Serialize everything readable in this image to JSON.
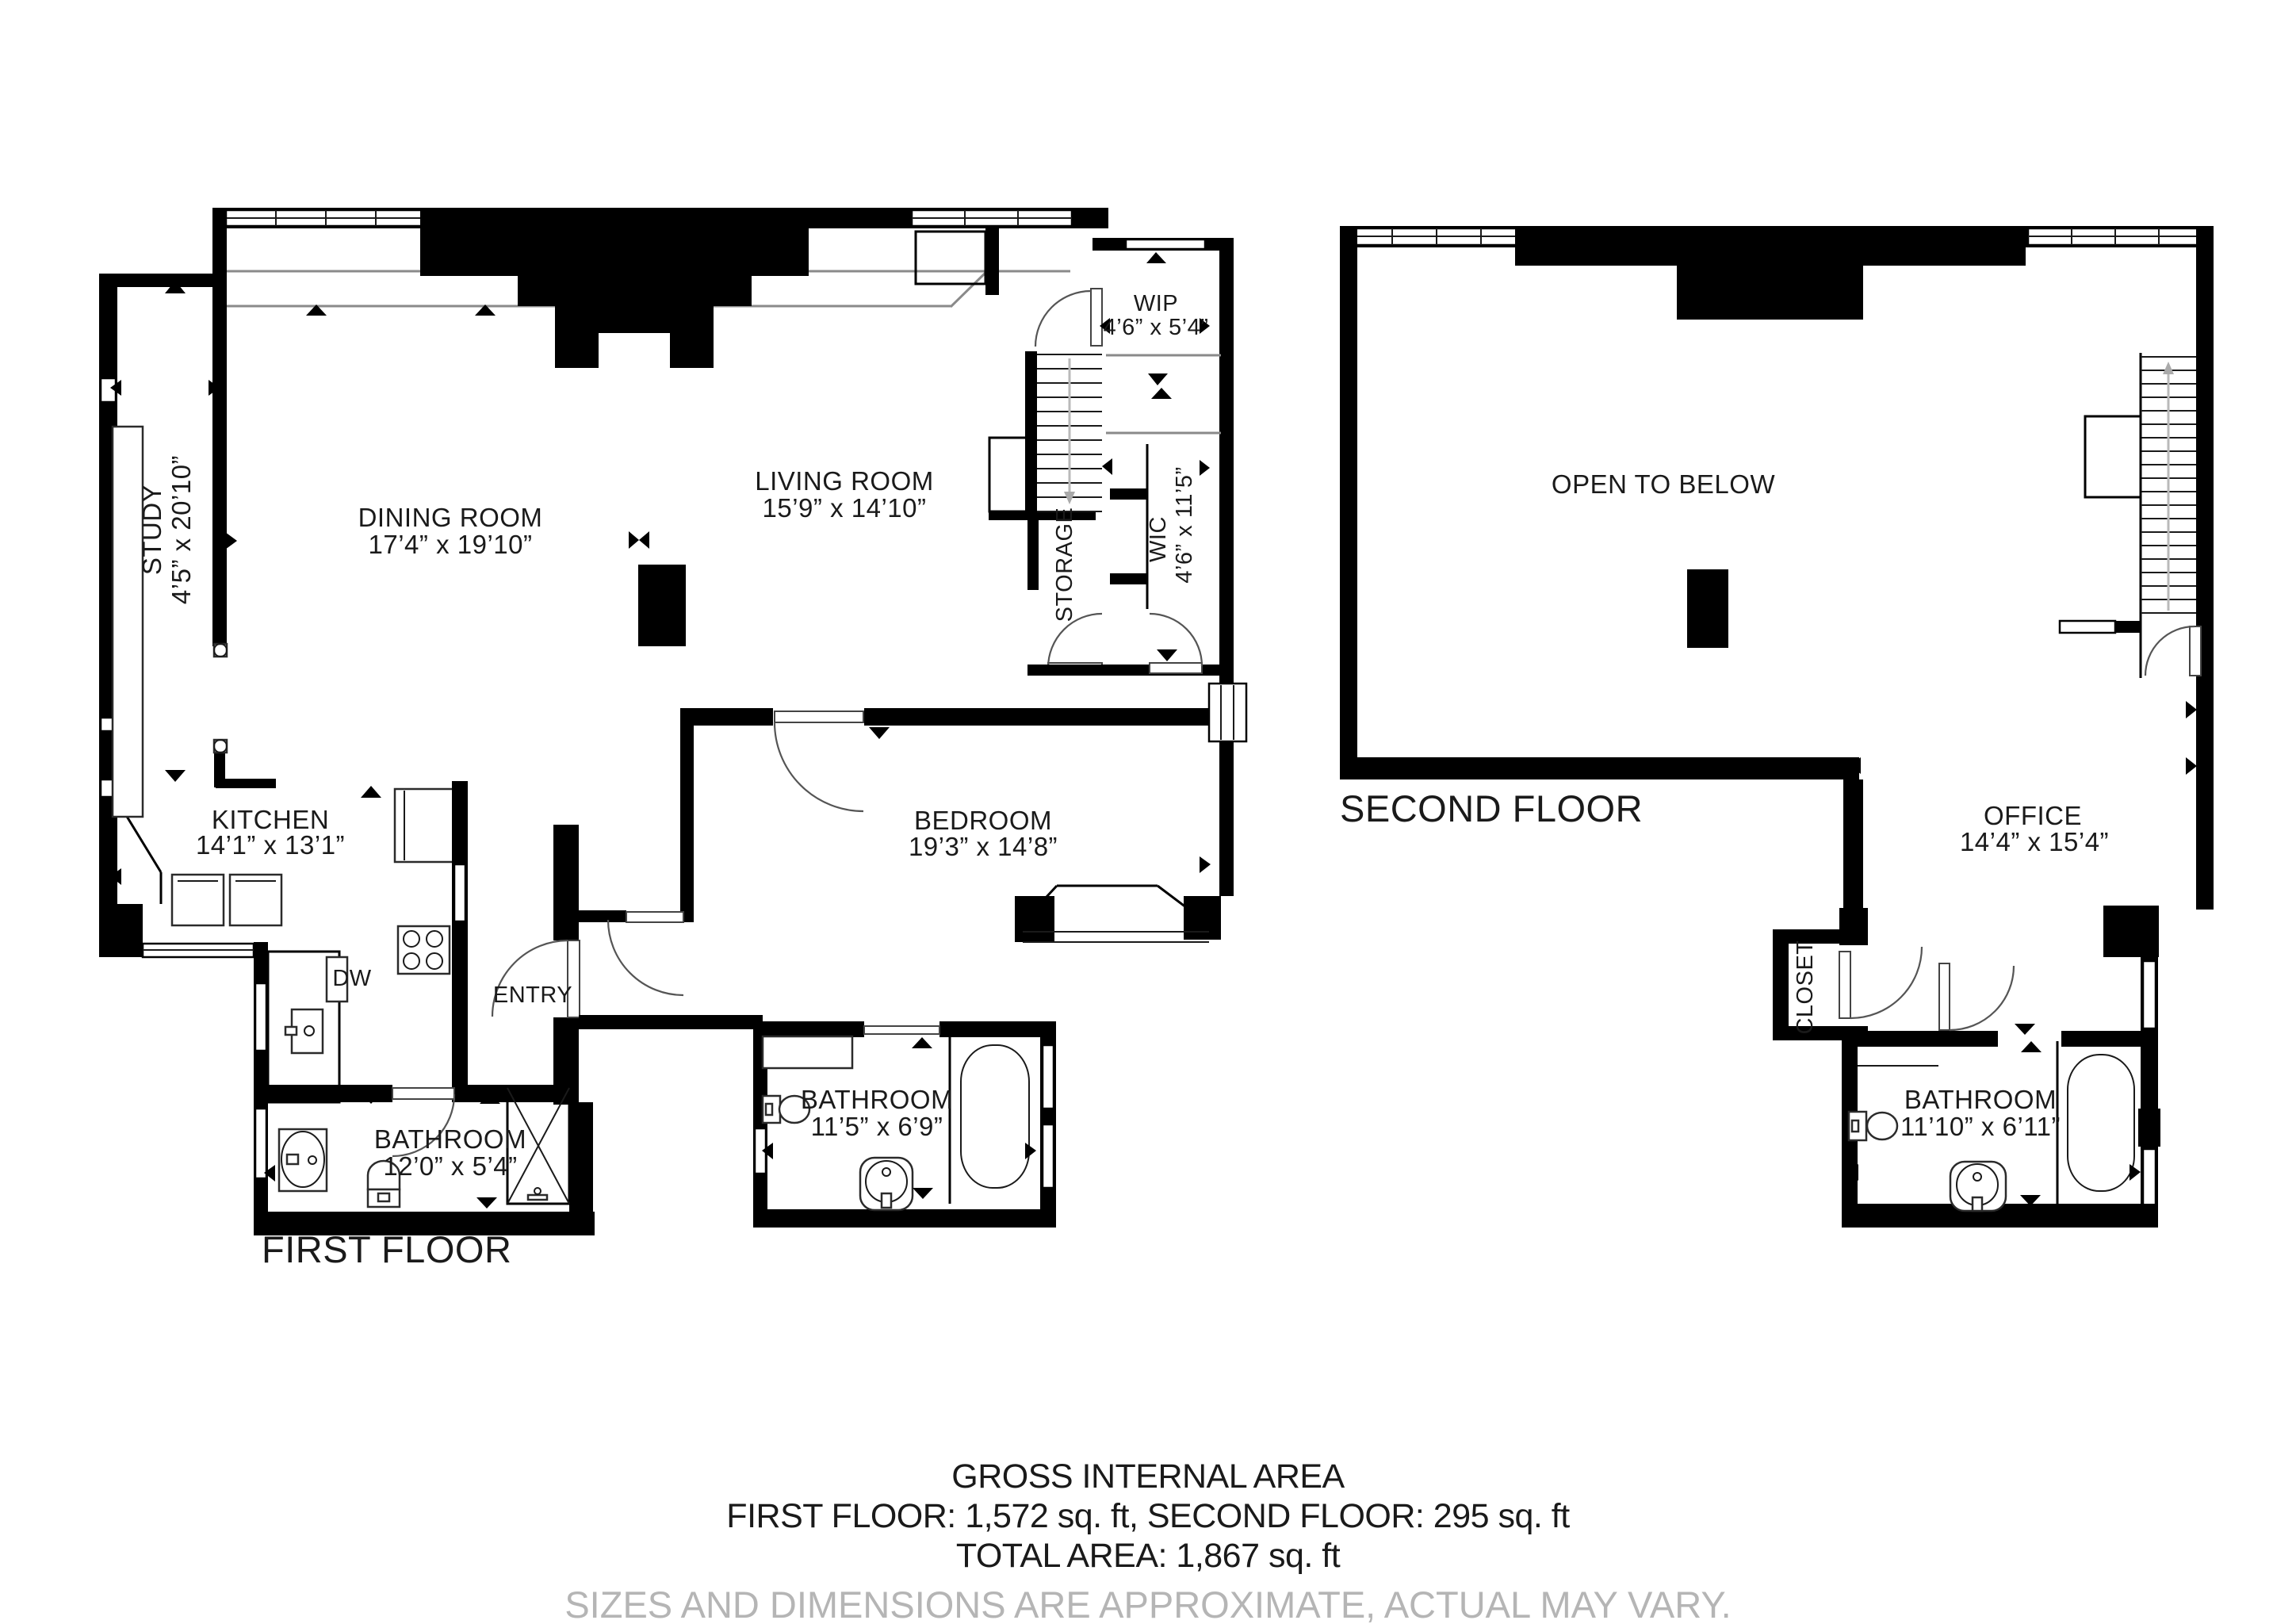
{
  "floor1": {
    "title": "FIRST FLOOR",
    "rooms": {
      "study": {
        "name": "STUDY",
        "dims": "4’5” x 20’10”"
      },
      "dining": {
        "name": "DINING ROOM",
        "dims": "17’4” x 19’10”"
      },
      "living": {
        "name": "LIVING ROOM",
        "dims": "15’9” x 14’10”"
      },
      "wip": {
        "name": "WIP",
        "dims": "4’6” x 5’4”"
      },
      "storage": {
        "name": "STORAGE"
      },
      "wic": {
        "name": "WIC",
        "dims": "4’6” x 11’5”"
      },
      "kitchen": {
        "name": "KITCHEN",
        "dims": "14’1” x 13’1”"
      },
      "dishwasher": {
        "name": "DW"
      },
      "entry": {
        "name": "ENTRY"
      },
      "bathroom": {
        "name": "BATHROOM",
        "dims": "12’0” x 5’4”"
      },
      "bedroom": {
        "name": "BEDROOM",
        "dims": "19’3” x 14’8”"
      },
      "bedroom_bathroom": {
        "name": "BATHROOM",
        "dims": "11’5” x 6’9”"
      }
    }
  },
  "floor2": {
    "title": "SECOND FLOOR",
    "rooms": {
      "open_to_below": {
        "name": "OPEN TO BELOW"
      },
      "office": {
        "name": "OFFICE",
        "dims": "14’4” x 15’4”"
      },
      "closet": {
        "name": "CLOSET"
      },
      "bathroom": {
        "name": "BATHROOM",
        "dims": "11’10” x 6’11”"
      }
    }
  },
  "footer": {
    "heading": "GROSS INTERNAL AREA",
    "areas": "FIRST FLOOR: 1,572 sq. ft, SECOND FLOOR: 295 sq. ft",
    "total": "TOTAL AREA: 1,867 sq. ft",
    "disclaimer": "SIZES AND DIMENSIONS ARE APPROXIMATE, ACTUAL MAY VARY."
  },
  "colors": {
    "walls": "#000000",
    "text": "#1a1a1a",
    "disclaimer": "#b5b5b5"
  }
}
